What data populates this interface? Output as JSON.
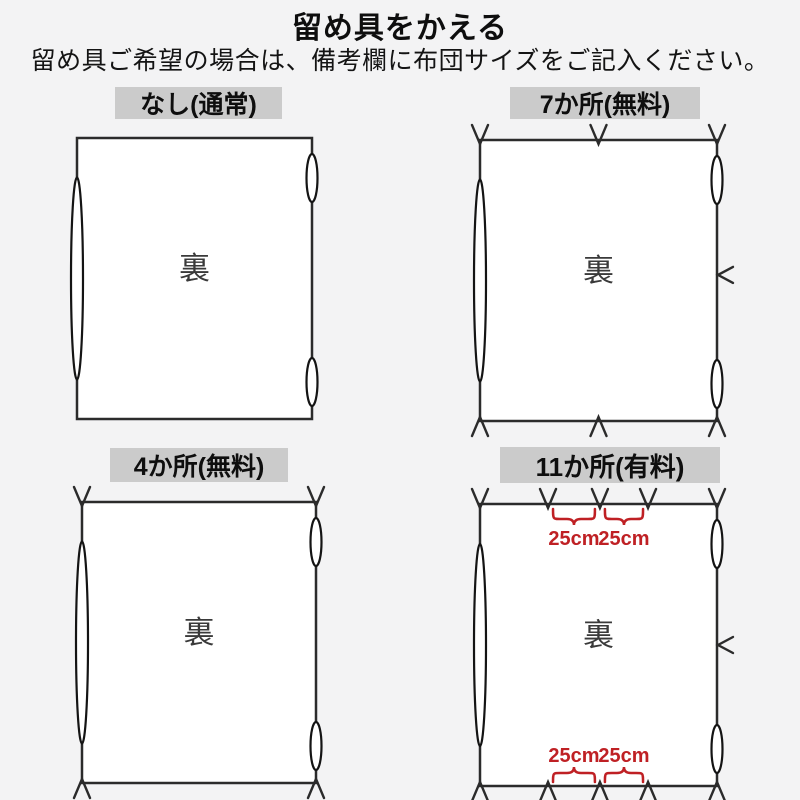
{
  "page": {
    "title": "留め具をかえる",
    "subtitle": "留め具ご希望の場合は、備考欄に布団サイズをご記入ください。"
  },
  "colors": {
    "background": "#f3f3f4",
    "line": "#2b2b2b",
    "panel_fill": "#ffffff",
    "label_bg": "#cbcbcb",
    "accent_red": "#bf2024",
    "back_text": "#3a3a3a"
  },
  "panels": [
    {
      "id": "none",
      "label": "なし(通常)",
      "back_label": "裏",
      "fastener_count": 0,
      "geometry": {
        "rect": {
          "x": 77,
          "y": 138,
          "w": 235,
          "h": 281
        }
      },
      "marks": {
        "top": [],
        "bottom": [],
        "right": []
      },
      "dimensions": []
    },
    {
      "id": "seven",
      "label": "7か所(無料)",
      "back_label": "裏",
      "fastener_count": 7,
      "geometry": {
        "rect": {
          "x": 480,
          "y": 140,
          "w": 237,
          "h": 281
        }
      },
      "marks": {
        "top": [
          0,
          0.5,
          1
        ],
        "bottom": [
          0,
          0.5,
          1
        ],
        "right": [
          0.48
        ]
      },
      "dimensions": []
    },
    {
      "id": "four",
      "label": "4か所(無料)",
      "back_label": "裏",
      "fastener_count": 4,
      "geometry": {
        "rect": {
          "x": 82,
          "y": 502,
          "w": 234,
          "h": 281
        }
      },
      "marks": {
        "top": [
          0,
          1
        ],
        "bottom": [
          0,
          1
        ],
        "right": []
      },
      "dimensions": []
    },
    {
      "id": "eleven",
      "label": "11か所(有料)",
      "back_label": "裏",
      "fastener_count": 11,
      "geometry": {
        "rect": {
          "x": 480,
          "y": 504,
          "w": 237,
          "h": 282
        }
      },
      "marks": {
        "top": [
          0,
          0.287,
          0.506,
          0.709,
          1
        ],
        "bottom": [
          0,
          0.287,
          0.506,
          0.709,
          1
        ],
        "right": [
          0.5
        ]
      },
      "dimensions": [
        {
          "edge": "top",
          "from": 0.287,
          "to": 0.506,
          "text": "25cm"
        },
        {
          "edge": "top",
          "from": 0.506,
          "to": 0.709,
          "text": "25cm"
        },
        {
          "edge": "bottom",
          "from": 0.287,
          "to": 0.506,
          "text": "25cm"
        },
        {
          "edge": "bottom",
          "from": 0.506,
          "to": 0.709,
          "text": "25cm"
        }
      ]
    }
  ]
}
